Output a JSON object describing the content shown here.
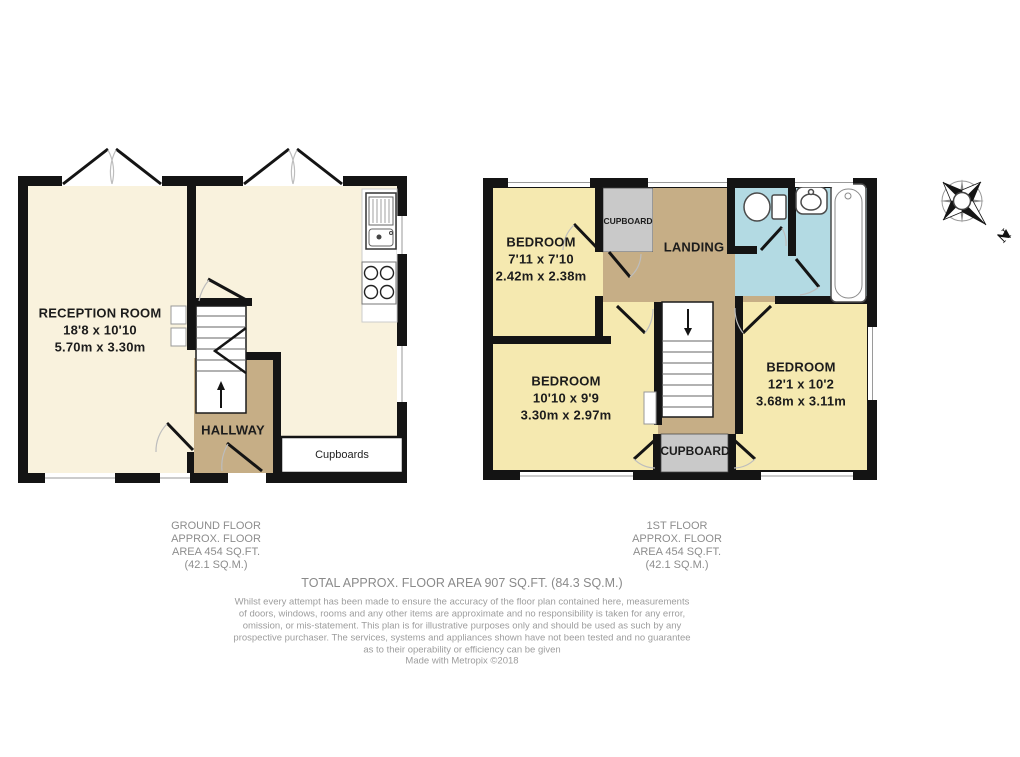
{
  "colors": {
    "ground_floor_room_fill": "#f9f2dd",
    "first_floor_room_fill": "#f5e9b0",
    "hall_landing_fill": "#c6ae86",
    "cupboard_fill": "#c9c9c9",
    "bathroom_fill": "#b3dae3",
    "wall": "#141414",
    "caption_text": "#8d8d8d",
    "disclaimer_text": "#9d9d9d"
  },
  "compass": {
    "north_label": "N"
  },
  "ground_floor": {
    "rooms": {
      "reception": {
        "name": "RECEPTION ROOM",
        "imperial": "18'8 x 10'10",
        "metric": "5.70m x 3.30m"
      },
      "hallway": {
        "name": "HALLWAY"
      },
      "cupboards": {
        "name": "Cupboards"
      }
    },
    "caption": [
      "GROUND FLOOR",
      "APPROX. FLOOR",
      "AREA 454 SQ.FT.",
      "(42.1 SQ.M.)"
    ]
  },
  "first_floor": {
    "rooms": {
      "bedroom1": {
        "name": "BEDROOM",
        "imperial": "7'11 x 7'10",
        "metric": "2.42m x 2.38m"
      },
      "bedroom2": {
        "name": "BEDROOM",
        "imperial": "10'10 x 9'9",
        "metric": "3.30m x 2.97m"
      },
      "bedroom3": {
        "name": "BEDROOM",
        "imperial": "12'1 x 10'2",
        "metric": "3.68m x 3.11m"
      },
      "landing": {
        "name": "LANDING"
      },
      "cupboard_top": {
        "name": "CUPBOARD"
      },
      "cupboard_bottom": {
        "name": "CUPBOARD"
      }
    },
    "caption": [
      "1ST FLOOR",
      "APPROX. FLOOR",
      "AREA 454 SQ.FT.",
      "(42.1 SQ.M.)"
    ]
  },
  "totals": {
    "total_line": "TOTAL APPROX. FLOOR AREA 907 SQ.FT. (84.3 SQ.M.)"
  },
  "disclaimer": {
    "lines": [
      "Whilst every attempt has been made to ensure the accuracy of the floor plan contained here, measurements",
      "of doors, windows, rooms and any other items are approximate and no responsibility is taken for any error,",
      "omission, or mis-statement. This plan is for illustrative purposes only and should be used as such by any",
      "prospective purchaser. The services, systems and appliances shown have not been tested and no guarantee",
      "as to their operability or efficiency can be given"
    ],
    "credit": "Made with Metropix ©2018"
  }
}
